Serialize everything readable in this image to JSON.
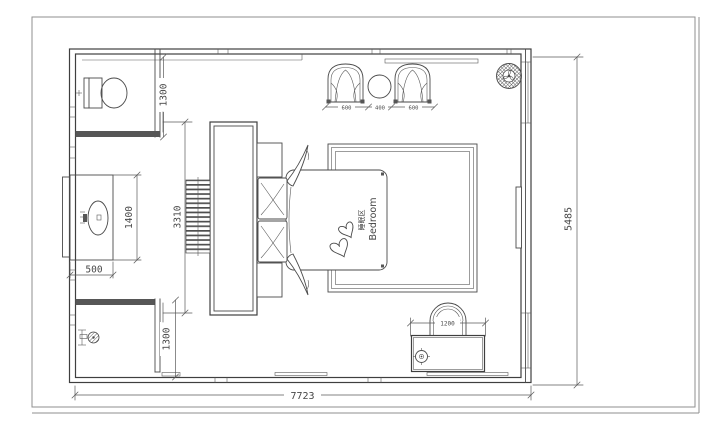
{
  "drawing": {
    "type": "floor-plan",
    "room_label_cn": "睡眠区",
    "room_label_en": "Bedroom",
    "colors": {
      "background": "#ffffff",
      "line": "#4a4a4a",
      "wall_fill": "#565656",
      "frame": "#8f8f8f",
      "text": "#474747"
    },
    "dimensions": {
      "overall_width": "7723",
      "overall_height": "5485",
      "wc_depth": "1300",
      "shower_depth": "1300",
      "vanity_length": "1400",
      "vanity_width": "500",
      "wardrobe_length": "3310",
      "lounge_chair_left": "600",
      "lounge_table": "400",
      "lounge_chair_right": "600",
      "desk_width": "1200"
    }
  }
}
